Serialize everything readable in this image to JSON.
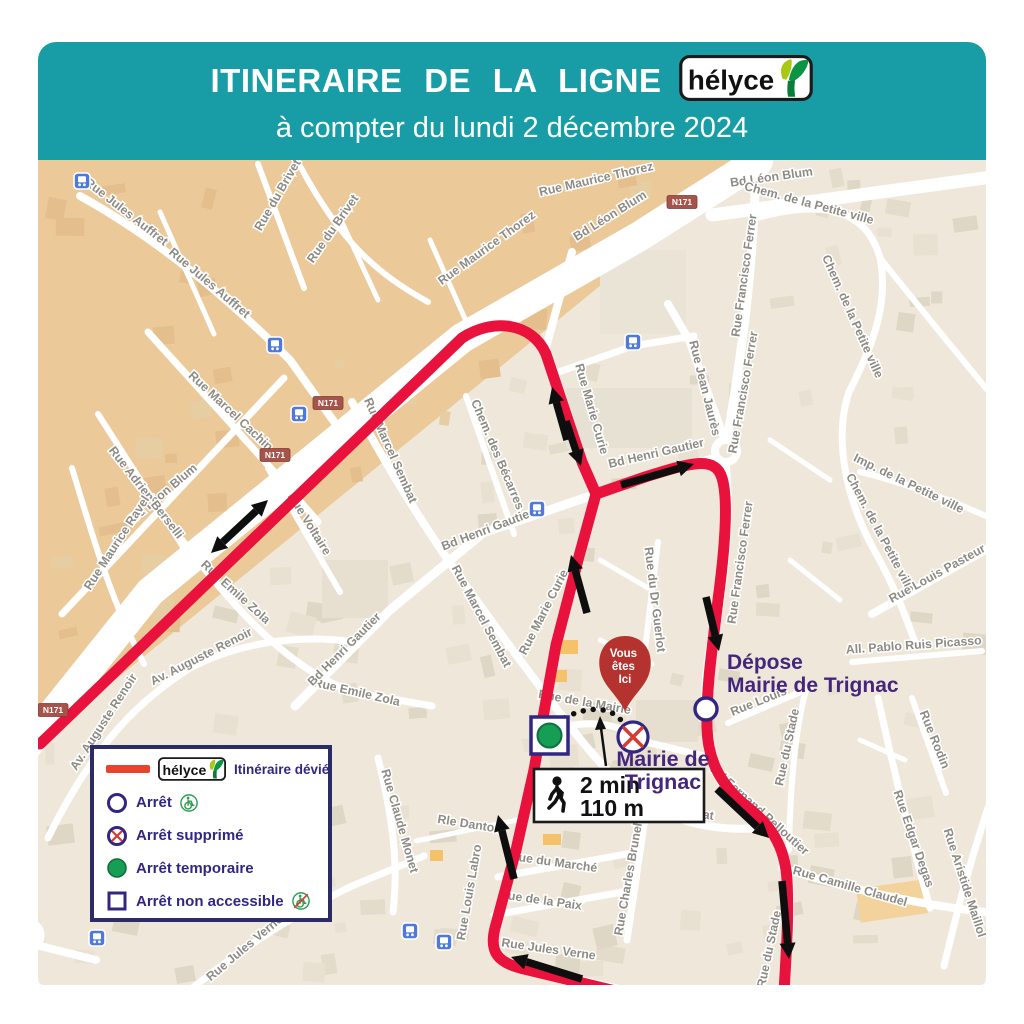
{
  "header": {
    "title": "ITINERAIRE DE LA LIGNE",
    "brand": "hélyce",
    "subtitle": "à compter du lundi 2 décembre 2024"
  },
  "legend": {
    "brand": "hélyce",
    "items": [
      {
        "label": "Itinéraire dévié"
      },
      {
        "label": "Arrêt"
      },
      {
        "label": "Arrêt supprimé"
      },
      {
        "label": "Arrêt temporaire"
      },
      {
        "label": "Arrêt non accessible"
      }
    ]
  },
  "map": {
    "road_badge": "N171",
    "you_are_here": {
      "line1": "Vous",
      "line2": "êtes",
      "line3": "Ici"
    },
    "walk": {
      "duration": "2 min",
      "distance": "110 m"
    },
    "poi_labels": {
      "depose_line1": "Dépose",
      "depose_line2": "Mairie de Trignac",
      "mairie_line1": "Mairie de",
      "mairie_line2": "Trignac"
    },
    "badges": [
      {
        "x": 682,
        "y": 202
      },
      {
        "x": 328,
        "y": 403
      },
      {
        "x": 275,
        "y": 455
      },
      {
        "x": 53,
        "y": 710
      }
    ],
    "bus_stops": [
      {
        "x": 82,
        "y": 181
      },
      {
        "x": 275,
        "y": 345
      },
      {
        "x": 299,
        "y": 414
      },
      {
        "x": 633,
        "y": 342
      },
      {
        "x": 537,
        "y": 509
      },
      {
        "x": 410,
        "y": 931
      },
      {
        "x": 444,
        "y": 942
      },
      {
        "x": 97,
        "y": 938
      }
    ],
    "street_labels": [
      {
        "t": "Rue Jules Auffret",
        "x": 124,
        "y": 215,
        "r": 38
      },
      {
        "t": "Rue Jules Auffret",
        "x": 207,
        "y": 286,
        "r": 40
      },
      {
        "t": "Rue du Brivet",
        "x": 281,
        "y": 197,
        "r": -60
      },
      {
        "t": "Rue du Brivet",
        "x": 336,
        "y": 231,
        "r": -55
      },
      {
        "t": "Rue Marcel Cachin",
        "x": 228,
        "y": 414,
        "r": 43
      },
      {
        "t": "Rue Maurice Thorez",
        "x": 489,
        "y": 251,
        "r": -36
      },
      {
        "t": "Rue Maurice Thorez",
        "x": 597,
        "y": 183,
        "r": -13
      },
      {
        "t": "Bd Léon Blum",
        "x": 612,
        "y": 219,
        "r": -32
      },
      {
        "t": "Bd Léon Blum",
        "x": 772,
        "y": 181,
        "r": -8
      },
      {
        "t": "Bd Léon Blum",
        "x": 166,
        "y": 496,
        "r": -40
      },
      {
        "t": "Rue Adrien Berselli",
        "x": 143,
        "y": 495,
        "r": 52
      },
      {
        "t": "Rue Maurice Ravel",
        "x": 120,
        "y": 545,
        "r": -57
      },
      {
        "t": "Rue Emile Zola",
        "x": 233,
        "y": 595,
        "r": 42
      },
      {
        "t": "Rue Emile Zola",
        "x": 356,
        "y": 696,
        "r": 13
      },
      {
        "t": "Av. Auguste Renoir",
        "x": 203,
        "y": 660,
        "r": -27
      },
      {
        "t": "Av. Auguste Renoir",
        "x": 107,
        "y": 724,
        "r": -57
      },
      {
        "t": "Rue Voltaire",
        "x": 306,
        "y": 526,
        "r": 58
      },
      {
        "t": "Rue Marcel Sembat",
        "x": 387,
        "y": 452,
        "r": 66
      },
      {
        "t": "Rue Marcel Sembat",
        "x": 478,
        "y": 618,
        "r": 62
      },
      {
        "t": "Rue Marcel Sembat",
        "x": 657,
        "y": 812,
        "r": 8
      },
      {
        "t": "Chem. des Bécarres",
        "x": 494,
        "y": 456,
        "r": 67
      },
      {
        "t": "Bd Henri Gautier",
        "x": 347,
        "y": 652,
        "r": -45
      },
      {
        "t": "Bd Henri Gautier",
        "x": 489,
        "y": 533,
        "r": -21
      },
      {
        "t": "Bd Henri Gautier",
        "x": 657,
        "y": 457,
        "r": -13
      },
      {
        "t": "Rue Marie Curie",
        "x": 588,
        "y": 410,
        "r": 74
      },
      {
        "t": "Rue Marie Curie",
        "x": 547,
        "y": 614,
        "r": -63
      },
      {
        "t": "Rue Jean Jaurès",
        "x": 701,
        "y": 389,
        "r": 76
      },
      {
        "t": "Rue Francisco Ferrer",
        "x": 748,
        "y": 276,
        "r": -82
      },
      {
        "t": "Rue Francisco Ferrer",
        "x": 747,
        "y": 393,
        "r": -80
      },
      {
        "t": "Rue Francisco Ferrer",
        "x": 744,
        "y": 563,
        "r": -82
      },
      {
        "t": "Chem. de la Petite ville",
        "x": 808,
        "y": 207,
        "r": 15
      },
      {
        "t": "Chem. de la Petite ville",
        "x": 849,
        "y": 318,
        "r": 66
      },
      {
        "t": "Chem. de la Petite ville",
        "x": 877,
        "y": 535,
        "r": 62
      },
      {
        "t": "Imp. de la Petite ville",
        "x": 907,
        "y": 487,
        "r": 26
      },
      {
        "t": "Rue Louis Pasteur",
        "x": 939,
        "y": 577,
        "r": -29
      },
      {
        "t": "All. Pablo Ruis Picasso",
        "x": 914,
        "y": 649,
        "r": -4
      },
      {
        "t": "Rue Rodin",
        "x": 931,
        "y": 741,
        "r": 68
      },
      {
        "t": "Rue Edgar Degas",
        "x": 910,
        "y": 840,
        "r": 71
      },
      {
        "t": "Rue Aristide Maillol",
        "x": 961,
        "y": 884,
        "r": 72
      },
      {
        "t": "Rue Camille Claudel",
        "x": 849,
        "y": 890,
        "r": 16
      },
      {
        "t": "Bd Fernand Pelloutier",
        "x": 757,
        "y": 813,
        "r": 42
      },
      {
        "t": "Rue du Stade",
        "x": 791,
        "y": 748,
        "r": -78
      },
      {
        "t": "Rue du Stade",
        "x": 773,
        "y": 950,
        "r": -78
      },
      {
        "t": "Rue Louis",
        "x": 760,
        "y": 705,
        "r": -22
      },
      {
        "t": "Rue du Dr Guerlot",
        "x": 651,
        "y": 600,
        "r": 83
      },
      {
        "t": "Rue de la Mairie",
        "x": 584,
        "y": 706,
        "r": 10
      },
      {
        "t": "Rue Claude Monet",
        "x": 396,
        "y": 822,
        "r": 74
      },
      {
        "t": "Rle Danton",
        "x": 469,
        "y": 828,
        "r": 9
      },
      {
        "t": "Rue Louis Labro",
        "x": 473,
        "y": 893,
        "r": -80
      },
      {
        "t": "Rue du Marché",
        "x": 553,
        "y": 866,
        "r": 8
      },
      {
        "t": "Rue de la Paix",
        "x": 540,
        "y": 904,
        "r": 8
      },
      {
        "t": "Rue Jules Verne",
        "x": 548,
        "y": 953,
        "r": 8
      },
      {
        "t": "Rue Jules Verne",
        "x": 247,
        "y": 951,
        "r": -40
      },
      {
        "t": "Rue Charles Brunelière",
        "x": 634,
        "y": 869,
        "r": -80
      }
    ],
    "route_arrows": [
      {
        "x1": 211,
        "y1": 553,
        "x2": 268,
        "y2": 500,
        "heads": 2
      },
      {
        "x1": 567,
        "y1": 440,
        "x2": 552,
        "y2": 387,
        "heads": 1
      },
      {
        "x1": 566,
        "y1": 421,
        "x2": 581,
        "y2": 466,
        "heads": 1
      },
      {
        "x1": 587,
        "y1": 613,
        "x2": 571,
        "y2": 555,
        "heads": 1
      },
      {
        "x1": 621,
        "y1": 485,
        "x2": 694,
        "y2": 464,
        "heads": 1
      },
      {
        "x1": 706,
        "y1": 597,
        "x2": 719,
        "y2": 651,
        "heads": 1
      },
      {
        "x1": 717,
        "y1": 789,
        "x2": 769,
        "y2": 838,
        "heads": 1
      },
      {
        "x1": 782,
        "y1": 881,
        "x2": 789,
        "y2": 959,
        "heads": 1
      },
      {
        "x1": 514,
        "y1": 879,
        "x2": 498,
        "y2": 815,
        "heads": 1
      },
      {
        "x1": 582,
        "y1": 979,
        "x2": 511,
        "y2": 957,
        "heads": 1
      }
    ]
  },
  "colors": {
    "teal": "#189DA6",
    "route_red": "#E8123D",
    "legend_red": "#E8432C",
    "navy": "#312783",
    "purple": "#44267E",
    "stop_green": "#169E55",
    "pin_red": "#B5332E",
    "map_beige": "#EFE7D9",
    "map_orange": "#ECC998"
  }
}
